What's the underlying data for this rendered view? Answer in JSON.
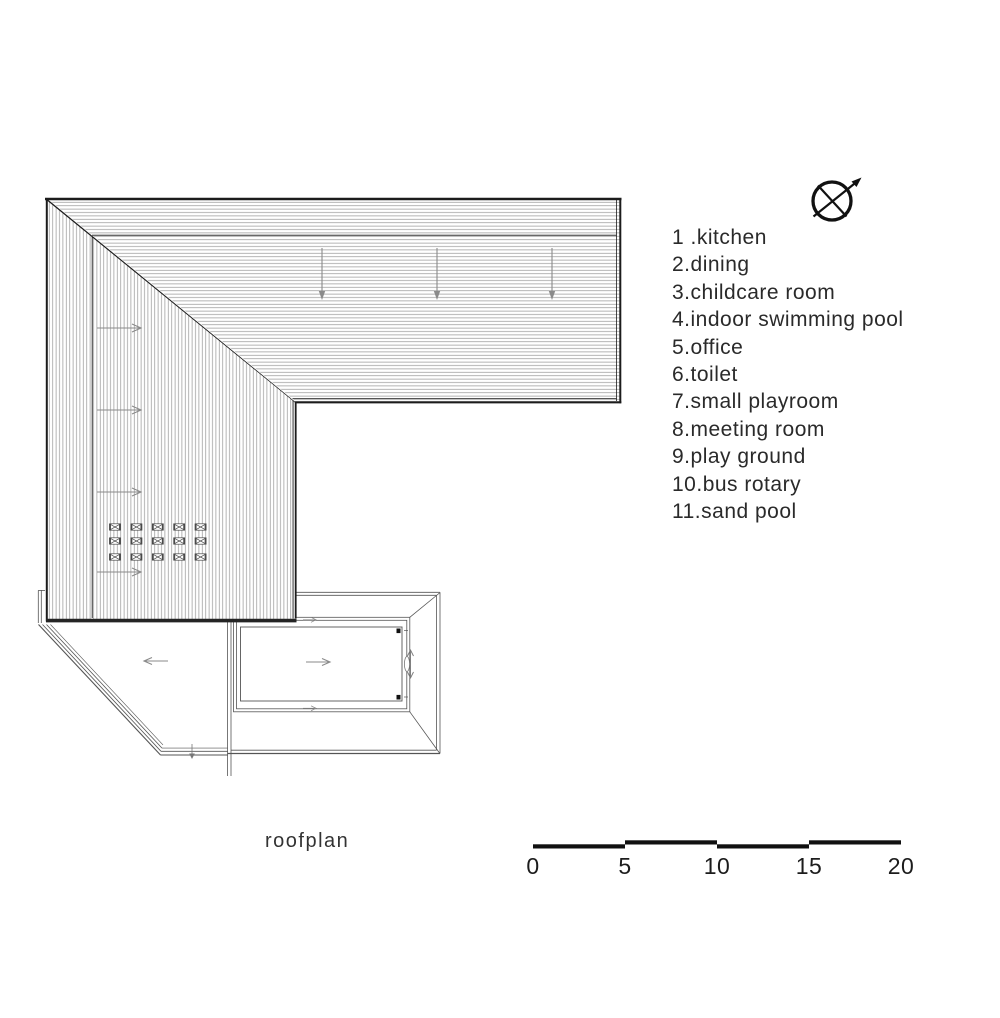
{
  "caption": "roofplan",
  "legend": {
    "items": [
      "1 .kitchen",
      "2.dining",
      "3.childcare room",
      "4.indoor swimming pool",
      "5.office",
      "6.toilet",
      "7.small playroom",
      "8.meeting room",
      "9.play ground",
      "10.bus rotary",
      "11.sand pool"
    ]
  },
  "scale_bar": {
    "labels": [
      "0",
      "5",
      "10",
      "15",
      "20"
    ]
  },
  "icons": {
    "north_arrow": "crossed-circle-with-northeast-arrow"
  },
  "colors": {
    "ink": "#1c1c1c",
    "hatch": "#9a9a9a",
    "arrow_gray": "#8a8a8a",
    "background": "#ffffff"
  }
}
